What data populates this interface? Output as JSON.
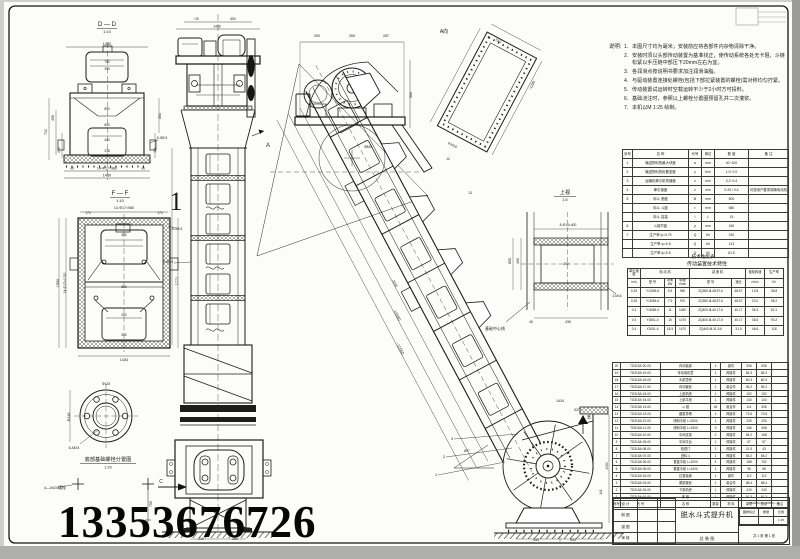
{
  "page": {
    "phone": "13353676726"
  },
  "notes": {
    "label": "说明:",
    "items": [
      "本图尺寸均为毫米；安装前应将各部件内杂物清除干净。",
      "安装时须以头部传动装置为基准找正，使传动系统各处无卡阻，斗链松紧以手压链中部压下20mm左右为宜。",
      "各润滑点按说明书要求加注润滑油脂。",
      "与驱动装置连接处螺栓(包括下部拉紧装置的螺栓)需对称均匀拧紧。",
      "传动装置试运转时空载运转不少于2小时方可投料。",
      "基础浇注时，参照以上螺栓分置图预留孔并二次灌浆。",
      "本机以M 1:25 绘制。"
    ]
  },
  "title_block": {
    "title": "脱水斗式提升机",
    "subtitle": "总 装 图",
    "code": "7.5A68×(Φ)—45M(—)··",
    "sheet_info": "共 1 张  第 1 张"
  },
  "tables": {
    "param": {
      "col_widths": [
        10,
        56,
        13,
        13,
        34,
        40
      ],
      "rows": [
        [
          "序号",
          "名          称",
          "代号",
          "单位",
          "数   值",
          "备    注"
        ],
        [
          "1",
          "输送物料的最大块度",
          "a",
          "mm",
          "40~100",
          ""
        ],
        [
          "2",
          "输送物料的松散密度",
          "γ",
          "t/m³",
          "1.0~2.0",
          ""
        ],
        [
          "3",
          "运输机牵引机构速度",
          "v",
          "m/s",
          "0.2~0.4",
          ""
        ],
        [
          "4",
          "牵引速度",
          "v",
          "m/s",
          "0.25 / 0.4",
          "可按用户要求调换电动机"
        ],
        [
          "5",
          "料斗  宽度",
          "B",
          "mm",
          "500",
          ""
        ],
        [
          "",
          "料斗  斗距",
          "t",
          "mm",
          "680",
          ""
        ],
        [
          "",
          "料斗  容量",
          "i",
          "L",
          "15",
          ""
        ],
        [
          "6",
          "斗链节距",
          "p",
          "mm",
          "160",
          ""
        ],
        [
          "7",
          "生产率  ψ=0.75",
          "Q",
          "t/h",
          "150",
          ""
        ],
        [
          "",
          "生产率  ψ=0.6",
          "Q",
          "t/h",
          "113",
          ""
        ],
        [
          "",
          "生产率  ψ=0.5",
          "Q",
          "t/h",
          "81.5",
          ""
        ]
      ]
    },
    "trans": {
      "col_widths": [
        13,
        24,
        11,
        14,
        42,
        14,
        19,
        19
      ],
      "rows": [
        [
          "牵引速度",
          {
            "t": "电  动  机",
            "cs": 3
          },
          {
            "t": "减  速  机",
            "cs": 2
          },
          "链轮转速",
          "生产率"
        ],
        [
          "m/s",
          "型 号",
          "功率 kW",
          "转速 r/min",
          "型        号",
          "速比",
          "r/min",
          "t/h"
        ],
        [
          "0.25",
          "Y132M-6",
          "5.5",
          "960",
          "ZQ350-Ⅲ-48.57-Ⅱ",
          "48.57",
          "19.8",
          "38.8"
        ],
        [
          "0.25",
          "Y160M-6",
          "7.5",
          "970",
          "ZQ350-Ⅲ-48.57-Ⅱ",
          "48.57",
          "20.0",
          "58.2"
        ],
        [
          "0.4",
          "Y160M-4",
          "11",
          "1460",
          "ZQ400-Ⅲ-40.17-Ⅱ",
          "40.17",
          "36.3",
          "62.1"
        ],
        [
          "0.4",
          "Y180L-4",
          "15",
          "1470",
          "ZQ400-Ⅲ-40.17-Ⅱ",
          "40.17",
          "36.6",
          "93.2"
        ],
        [
          "0.4",
          "Y200L-4",
          "18.5",
          "1470",
          "ZQ400-Ⅲ-31.5-Ⅱ",
          "31.5",
          "46.6",
          "118"
        ]
      ]
    },
    "bom": {
      "col_widths": [
        8,
        40,
        50,
        10,
        21,
        15,
        15,
        17
      ],
      "rows": [
        [
          "20",
          "TD315A·20-00",
          "传动装置",
          "1",
          "部件",
          "536",
          "536",
          ""
        ],
        [
          "19",
          "TD315A·19-00",
          "传动电机罩",
          "1",
          "焊接件",
          "86.3",
          "86.3",
          ""
        ],
        [
          "18",
          "TD315A·18-00",
          "头部罩壳",
          "1",
          "焊接件",
          "80.3",
          "80.3",
          ""
        ],
        [
          "17",
          "TD315A·17-00",
          "传动链轮",
          "1",
          "组合件",
          "96.2",
          "96.2",
          ""
        ],
        [
          "16",
          "TD315A·16-00",
          "上部机壳",
          "1",
          "焊接件",
          "152",
          "152",
          ""
        ],
        [
          "15",
          "TD315A·15-00",
          "上部平段",
          "1",
          "焊接件",
          "134",
          "134",
          ""
        ],
        [
          "14",
          "TD315A·14-00",
          "斗  链",
          "45",
          "组合件",
          "6.8",
          "306",
          ""
        ],
        [
          "13",
          "TD315A·13-00",
          "圆弧导槽",
          "1",
          "焊接件",
          "73.6",
          "73.6",
          ""
        ],
        [
          "12",
          "TD315A·12-00",
          "倾斜中段 L=2000",
          "1",
          "焊接件",
          "205",
          "205",
          ""
        ],
        [
          "11",
          "TD315A·11-00",
          "倾斜中段 L=1500",
          "3",
          "焊接件",
          "166",
          "498",
          ""
        ],
        [
          "10",
          "TD315A·10-00",
          "中间支架",
          "2",
          "焊接件",
          "84.2",
          "168",
          ""
        ],
        [
          "9",
          "TD315A·09-00",
          "中间平台",
          "1",
          "焊接件",
          "57",
          "57",
          ""
        ],
        [
          "8",
          "TD315A·08-00",
          "检视门",
          "2",
          "焊接件",
          "21.5",
          "43",
          ""
        ],
        [
          "7",
          "TD315A·07-00",
          "进料斗",
          "1",
          "焊接件",
          "65.2",
          "65.2",
          ""
        ],
        [
          "6",
          "TD315A·06-00",
          "垂直中段 L=2000",
          "4",
          "焊接件",
          "188",
          "752",
          ""
        ],
        [
          "5",
          "TD315A·05-00",
          "垂直中段 L=1000",
          "1",
          "焊接件",
          "98",
          "98",
          ""
        ],
        [
          "4",
          "TD315A·04-00",
          "拉紧装置",
          "1",
          "部件",
          "112",
          "112",
          ""
        ],
        [
          "3",
          "TD315A·03-00",
          "尾部链轮",
          "1",
          "组合件",
          "88.4",
          "88.4",
          ""
        ],
        [
          "2",
          "TD315A·02-00",
          "下部机壳",
          "1",
          "焊接件",
          "243",
          "243",
          ""
        ],
        [
          "1",
          "TD315A·01-00",
          "底  座",
          "1",
          "焊接件",
          "91.3",
          "91.3",
          ""
        ],
        [
          "序号",
          "代    号",
          "名    称",
          "数量",
          "材 料",
          "单重",
          "总重",
          "备注"
        ]
      ]
    },
    "tb_left": {
      "col_widths": [
        24,
        20,
        18
      ],
      "rows": [
        [
          "设 计",
          "",
          ""
        ],
        [
          "制 图",
          "",
          ""
        ],
        [
          "描 图",
          "",
          ""
        ],
        [
          "审 核",
          "",
          ""
        ]
      ]
    },
    "tb_right": {
      "col_widths": [
        18,
        14,
        14
      ],
      "rows": [
        [
          "图样标记",
          "重量",
          "比例"
        ],
        [
          "",
          "",
          "1:25"
        ]
      ]
    }
  },
  "annotations": [
    {
      "t": "D — D",
      "x": 107,
      "y": 26,
      "s": 6,
      "n": "view-title-dd"
    },
    {
      "t": "1:10",
      "x": 107,
      "y": 33,
      "s": 4,
      "n": "view-scale-dd"
    },
    {
      "t": "1430",
      "x": 107,
      "y": 45,
      "s": 3.8
    },
    {
      "t": "750",
      "x": 107,
      "y": 63,
      "s": 3.2
    },
    {
      "t": "290",
      "x": 107,
      "y": 70,
      "s": 3.2
    },
    {
      "t": "850",
      "x": 107,
      "y": 110,
      "s": 3.2
    },
    {
      "t": "600",
      "x": 107,
      "y": 126,
      "s": 3.2
    },
    {
      "t": "444",
      "x": 107,
      "y": 141,
      "s": 3.2
    },
    {
      "t": "238",
      "x": 107,
      "y": 152,
      "s": 3.2
    },
    {
      "t": "14-Φ17=980",
      "x": 107,
      "y": 169.5,
      "s": 3.6
    },
    {
      "t": "46",
      "x": 72,
      "y": 169.5,
      "s": 3.2
    },
    {
      "t": "46",
      "x": 143,
      "y": 169.5,
      "s": 3.2
    },
    {
      "t": "1430",
      "x": 107,
      "y": 176.5,
      "s": 3.8
    },
    {
      "t": "450",
      "x": 54,
      "y": 118,
      "s": 3.6,
      "r": -90
    },
    {
      "t": "712",
      "x": 47,
      "y": 132,
      "s": 3.6,
      "r": -90
    },
    {
      "t": "210",
      "x": 60,
      "y": 150,
      "s": 3.4,
      "r": -90
    },
    {
      "t": "361",
      "x": 161,
      "y": 116,
      "s": 3.6,
      "r": -90
    },
    {
      "t": "101",
      "x": 156,
      "y": 150,
      "s": 3.4,
      "r": -90
    },
    {
      "t": "6-Φ8.5",
      "x": 162,
      "y": 139,
      "s": 3.4
    },
    {
      "t": "F — F",
      "x": 120,
      "y": 195,
      "s": 6,
      "n": "view-title-ff"
    },
    {
      "t": "1:10",
      "x": 120,
      "y": 202,
      "s": 4,
      "n": "view-scale-ff"
    },
    {
      "t": "14-Φ17=980",
      "x": 124,
      "y": 209,
      "s": 3.6
    },
    {
      "t": "170",
      "x": 88,
      "y": 214,
      "s": 3.2
    },
    {
      "t": "170",
      "x": 160,
      "y": 214,
      "s": 3.2
    },
    {
      "t": "300",
      "x": 124,
      "y": 236,
      "s": 3.2
    },
    {
      "t": "800",
      "x": 124,
      "y": 288,
      "s": 3.2
    },
    {
      "t": "260",
      "x": 124,
      "y": 316,
      "s": 3.2
    },
    {
      "t": "530",
      "x": 124,
      "y": 336,
      "s": 3.2
    },
    {
      "t": "1434",
      "x": 124,
      "y": 361,
      "s": 3.8
    },
    {
      "t": "14-Φ17=1030",
      "x": 66,
      "y": 283,
      "s": 3.4,
      "r": -90
    },
    {
      "t": "1590",
      "x": 59,
      "y": 283,
      "s": 3.8,
      "r": -90
    },
    {
      "t": "1771",
      "x": 178,
      "y": 281,
      "s": 3.8,
      "r": -90
    },
    {
      "t": "4-Φ8.5",
      "x": 177,
      "y": 230,
      "s": 3.4
    },
    {
      "t": "1",
      "x": 176,
      "y": 210,
      "s": 26,
      "c": "#777",
      "f": "Liberation Serif, DejaVu Serif, serif",
      "n": "sheet-number"
    },
    {
      "t": "Φ248",
      "x": 70,
      "y": 417,
      "s": 3.6,
      "r": -90
    },
    {
      "t": "Φ125",
      "x": 106,
      "y": 385,
      "s": 3.4
    },
    {
      "t": "6-M24",
      "x": 74,
      "y": 449,
      "s": 3.8
    },
    {
      "t": "底部基础螺栓分置图",
      "x": 108,
      "y": 461,
      "s": 5.2,
      "n": "view-title-foundation"
    },
    {
      "t": "1:20",
      "x": 108,
      "y": 468.5,
      "s": 3.8,
      "n": "view-scale-foundation"
    },
    {
      "t": "4—M24螺栓",
      "x": 55,
      "y": 489,
      "s": 4
    },
    {
      "t": "750",
      "x": 152,
      "y": 504,
      "s": 3.6,
      "r": -90
    },
    {
      "t": "C",
      "x": 161,
      "y": 483,
      "s": 5,
      "n": "view-arrow-c"
    },
    {
      "t": "~25",
      "x": 196,
      "y": 20,
      "s": 3.2
    },
    {
      "t": "650",
      "x": 233,
      "y": 20,
      "s": 3.2
    },
    {
      "t": "1430",
      "x": 217,
      "y": 27.5,
      "s": 3.4
    },
    {
      "t": "A",
      "x": 268,
      "y": 147,
      "s": 6,
      "n": "view-arrow-a"
    },
    {
      "t": "8-Φ8.5",
      "x": 168,
      "y": 263,
      "s": 3.3
    },
    {
      "t": "1150",
      "x": 218,
      "y": 412,
      "s": 3.3
    },
    {
      "t": "210",
      "x": 201,
      "y": 540,
      "s": 3.6
    },
    {
      "t": "350",
      "x": 235,
      "y": 540,
      "s": 3.6
    },
    {
      "t": "300",
      "x": 317,
      "y": 37,
      "s": 3.6
    },
    {
      "t": "265",
      "x": 352,
      "y": 37,
      "s": 3.6
    },
    {
      "t": "287",
      "x": 386,
      "y": 37,
      "s": 3.6
    },
    {
      "t": "560",
      "x": 412,
      "y": 95,
      "s": 3.6,
      "r": -90
    },
    {
      "t": "Φ820",
      "x": 368,
      "y": 148,
      "s": 3.4
    },
    {
      "t": "A向",
      "x": 444,
      "y": 33,
      "s": 5,
      "n": "view-title-a"
    },
    {
      "t": "510",
      "x": 498,
      "y": 42,
      "s": 3.6,
      "r": 28
    },
    {
      "t": "~1286",
      "x": 533,
      "y": 86,
      "s": 3.6,
      "r": -62
    },
    {
      "t": "8-M16",
      "x": 452,
      "y": 146,
      "s": 3.4,
      "r": 28
    },
    {
      "t": "~11550",
      "x": 399,
      "y": 349,
      "s": 4,
      "r": 62
    },
    {
      "t": "10580",
      "x": 396,
      "y": 316,
      "s": 4,
      "r": 62
    },
    {
      "t": "2030",
      "x": 394,
      "y": 284,
      "s": 3.4,
      "r": 62
    },
    {
      "t": "12",
      "x": 448,
      "y": 160,
      "s": 3.4
    },
    {
      "t": "13",
      "x": 470,
      "y": 194,
      "s": 3.4
    },
    {
      "t": "上视",
      "x": 565,
      "y": 194,
      "s": 5.2,
      "n": "view-title-rail"
    },
    {
      "t": "1:5",
      "x": 565,
      "y": 201,
      "s": 3.8,
      "n": "view-scale-rail"
    },
    {
      "t": "8-Φ14=400",
      "x": 568,
      "y": 226,
      "s": 3.3
    },
    {
      "t": "400",
      "x": 519,
      "y": 261,
      "s": 3.6,
      "r": -90
    },
    {
      "t": "855",
      "x": 511,
      "y": 261,
      "s": 3.6,
      "r": -90
    },
    {
      "t": "300",
      "x": 566,
      "y": 265,
      "s": 3.2
    },
    {
      "t": "430",
      "x": 568,
      "y": 323,
      "s": 3.6
    },
    {
      "t": "45",
      "x": 531,
      "y": 323,
      "s": 3.2
    },
    {
      "t": "基础中心线",
      "x": 495,
      "y": 330,
      "s": 4
    },
    {
      "t": "2-M16",
      "x": 617,
      "y": 297,
      "s": 3.2
    },
    {
      "t": "1434",
      "x": 560,
      "y": 402,
      "s": 3.6
    },
    {
      "t": "527",
      "x": 577,
      "y": 411,
      "s": 3.3
    },
    {
      "t": "B",
      "x": 589,
      "y": 419,
      "s": 5,
      "n": "view-arrow-b"
    },
    {
      "t": "60°",
      "x": 467,
      "y": 452,
      "s": 3.8
    },
    {
      "t": "545",
      "x": 536,
      "y": 541,
      "s": 3.6
    },
    {
      "t": "543",
      "x": 573,
      "y": 541,
      "s": 3.6
    },
    {
      "t": "1050",
      "x": 608,
      "y": 466,
      "s": 3.4,
      "r": -90
    },
    {
      "t": "141",
      "x": 602,
      "y": 492,
      "s": 3.2,
      "r": -90
    },
    {
      "t": "3",
      "x": 452,
      "y": 440,
      "s": 3.8
    },
    {
      "t": "2",
      "x": 444,
      "y": 458,
      "s": 3.8
    },
    {
      "t": "1",
      "x": 436,
      "y": 476,
      "s": 3.8
    },
    {
      "t": "技术性能表",
      "x": 703,
      "y": 258,
      "s": 4.6,
      "n": "param-table-caption"
    },
    {
      "t": "传动装置技术特性",
      "x": 707,
      "y": 265.5,
      "s": 5,
      "n": "trans-table-title"
    }
  ]
}
